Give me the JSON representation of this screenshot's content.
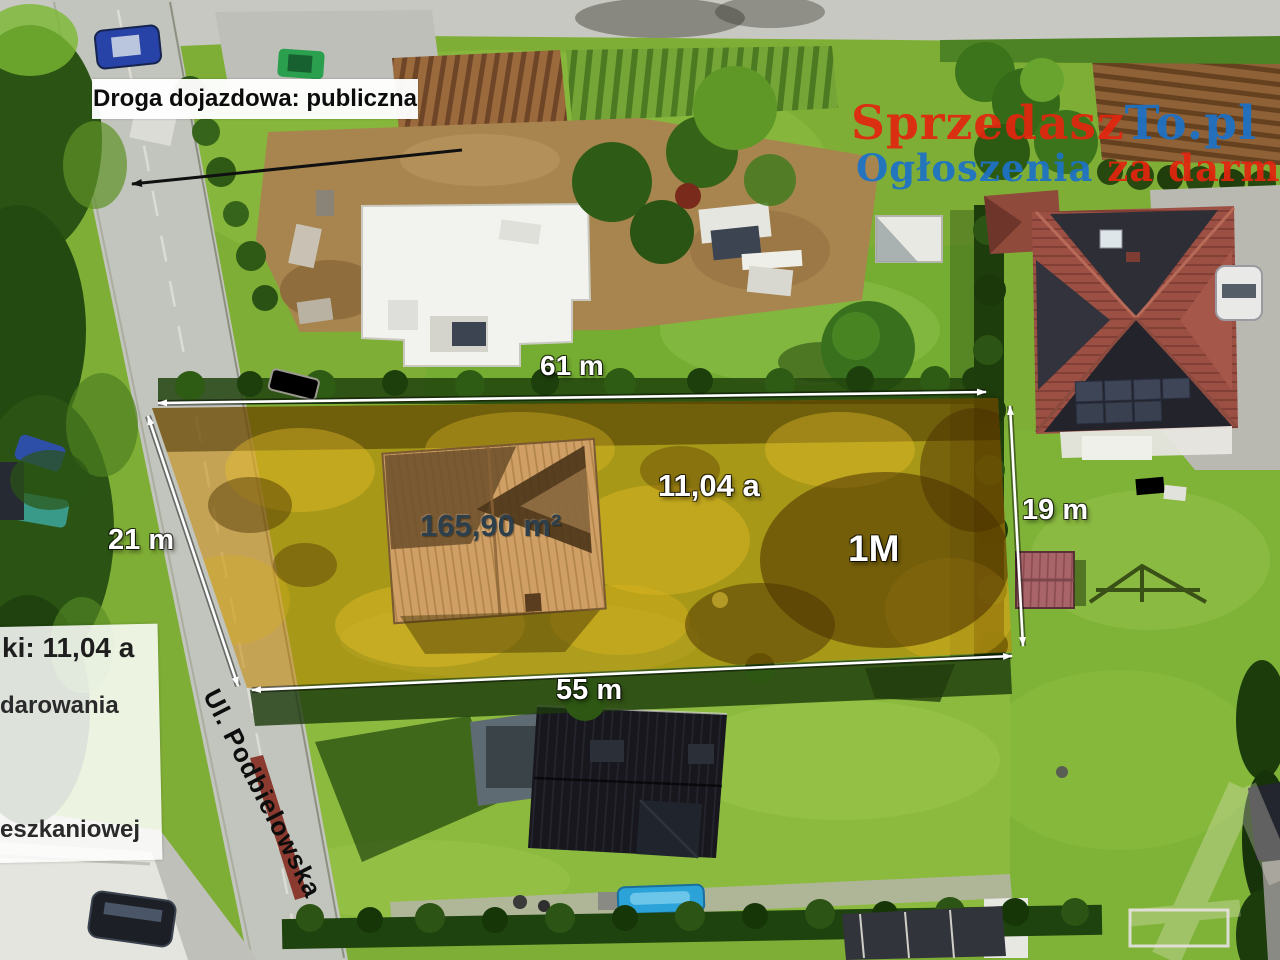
{
  "labels": {
    "road_access": "Droga dojazdowa: publiczna",
    "street": "Ul. Podbielowska",
    "plot_area": "11,04 a",
    "house_area": "165,90 m²",
    "zoning": "1M",
    "dim_top": "61 m",
    "dim_bottom": "55 m",
    "dim_left": "21 m",
    "dim_right": "19 m"
  },
  "info_panel": {
    "line1": "ki: 11,04 a",
    "line2": "darowania",
    "line3": "eszkaniowej"
  },
  "watermark": {
    "brand_red": "Sprzedasz",
    "brand_blue": "To.pl",
    "tagline_blue": "Ogłoszenia",
    "tagline_red": "za darmo!",
    "color_red": "#e3250e",
    "color_blue": "#1c72c8"
  },
  "colors": {
    "plot_overlay": "#c98700",
    "dimension_arrows": "#ffffff"
  }
}
